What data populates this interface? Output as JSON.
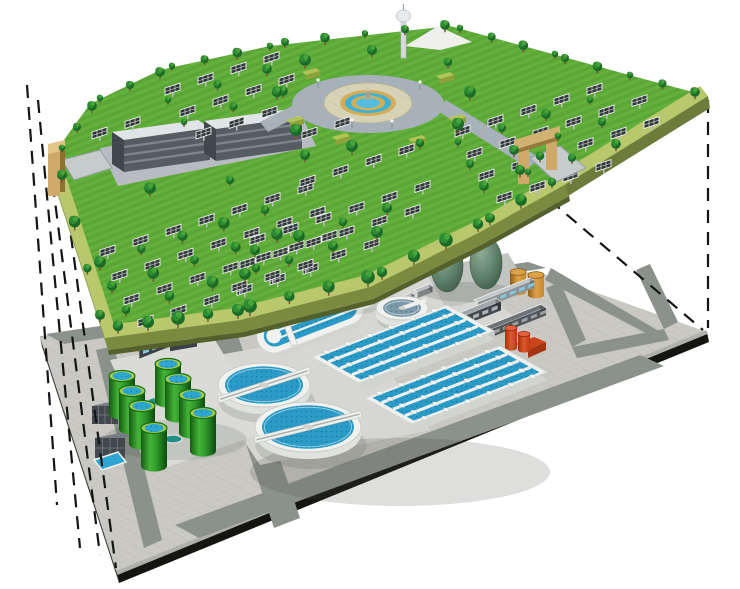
{
  "meta": {
    "title": "Cutaway illustration: ground-level solar park built above an underground wastewater treatment plant",
    "image_type": "3D architectural rendering",
    "width_px": 740,
    "height_px": 589
  },
  "scene": {
    "background_color": "#ffffff",
    "projection_lines": {
      "style": "dashed",
      "color": "#141414",
      "left_count": 4,
      "right_count": 2
    },
    "upper_level": {
      "name": "ground-level solar park",
      "features": [
        "solar panel arrays",
        "trees",
        "lawns",
        "central circular plaza with tiered fountain",
        "ring road",
        "observation tower",
        "two office buildings",
        "perimeter path",
        "left entrance gate",
        "right entrance gate",
        "hedge planters",
        "lamp posts"
      ],
      "counts": {
        "solar_panel_arrays": 84,
        "trees": 98,
        "office_buildings": 2,
        "gates": 2,
        "towers": 1,
        "fountains": 1
      },
      "colors": {
        "grass": "#63b03c",
        "path_border": "#b9c76d",
        "platform_side": "#7b8a3e",
        "platform_side_dark": "#55612c",
        "panel": "#30383a",
        "panel_frame": "#f2f2f2",
        "tree_dark": "#1c6b26",
        "tree_mid": "#2d8c31",
        "tree_light": "#47a43a",
        "trunk": "#7b5733",
        "plaza_ring_road": "#a7b1b9",
        "plaza_paving": "#d8d3b6",
        "fountain_stone": "#d2ae58",
        "fountain_water": "#3fb0d6",
        "building_gray": "#565c61",
        "building_roof": "#e0e4e6",
        "gate_tan": "#cfa967",
        "courtyard": "#b6bcc1"
      }
    },
    "lower_level": {
      "name": "underground wastewater treatment plant",
      "features": [
        "large circular clarifiers with skimmer bridges",
        "small sedimentation tanks",
        "oxidation ditches",
        "aeration basins with diffuser lanes",
        "green sludge storage tanks",
        "egg-shaped anaerobic digesters",
        "storage drums",
        "service buildings",
        "red pumping unit",
        "electrical transformer cabinets",
        "access roads",
        "tiled concrete deck"
      ],
      "counts": {
        "large_clarifiers": 2,
        "small_clarifiers": 2,
        "oxidation_ditches": 2,
        "aeration_basins": 2,
        "green_tanks": 8,
        "egg_digesters": 2,
        "orange_drums": 2,
        "service_buildings": 5,
        "transformer_cabinets": 2,
        "red_pump_units": 1
      },
      "colors": {
        "deck": "#cac9c3",
        "road": "#8b928b",
        "pad": "#d6d7d2",
        "edge": "#141511",
        "curb": "#aeb0a9",
        "side_left": "#3c3d39",
        "tank_white": "#f1f2f0",
        "tank_white_side": "#d2d4cf",
        "water_blue": "#2a9cc7",
        "water_steel": "#7b9aa9",
        "tank_green": "#2f9a2b",
        "tank_green_dark": "#135c12",
        "tank_rim": "#a7cd45",
        "tank_lid_blue": "#2fa6d1",
        "digester_green": "#5c7f68",
        "drum_orange": "#c78a30",
        "pump_red": "#ce4318",
        "navy_tank": "#223f5e"
      }
    }
  }
}
